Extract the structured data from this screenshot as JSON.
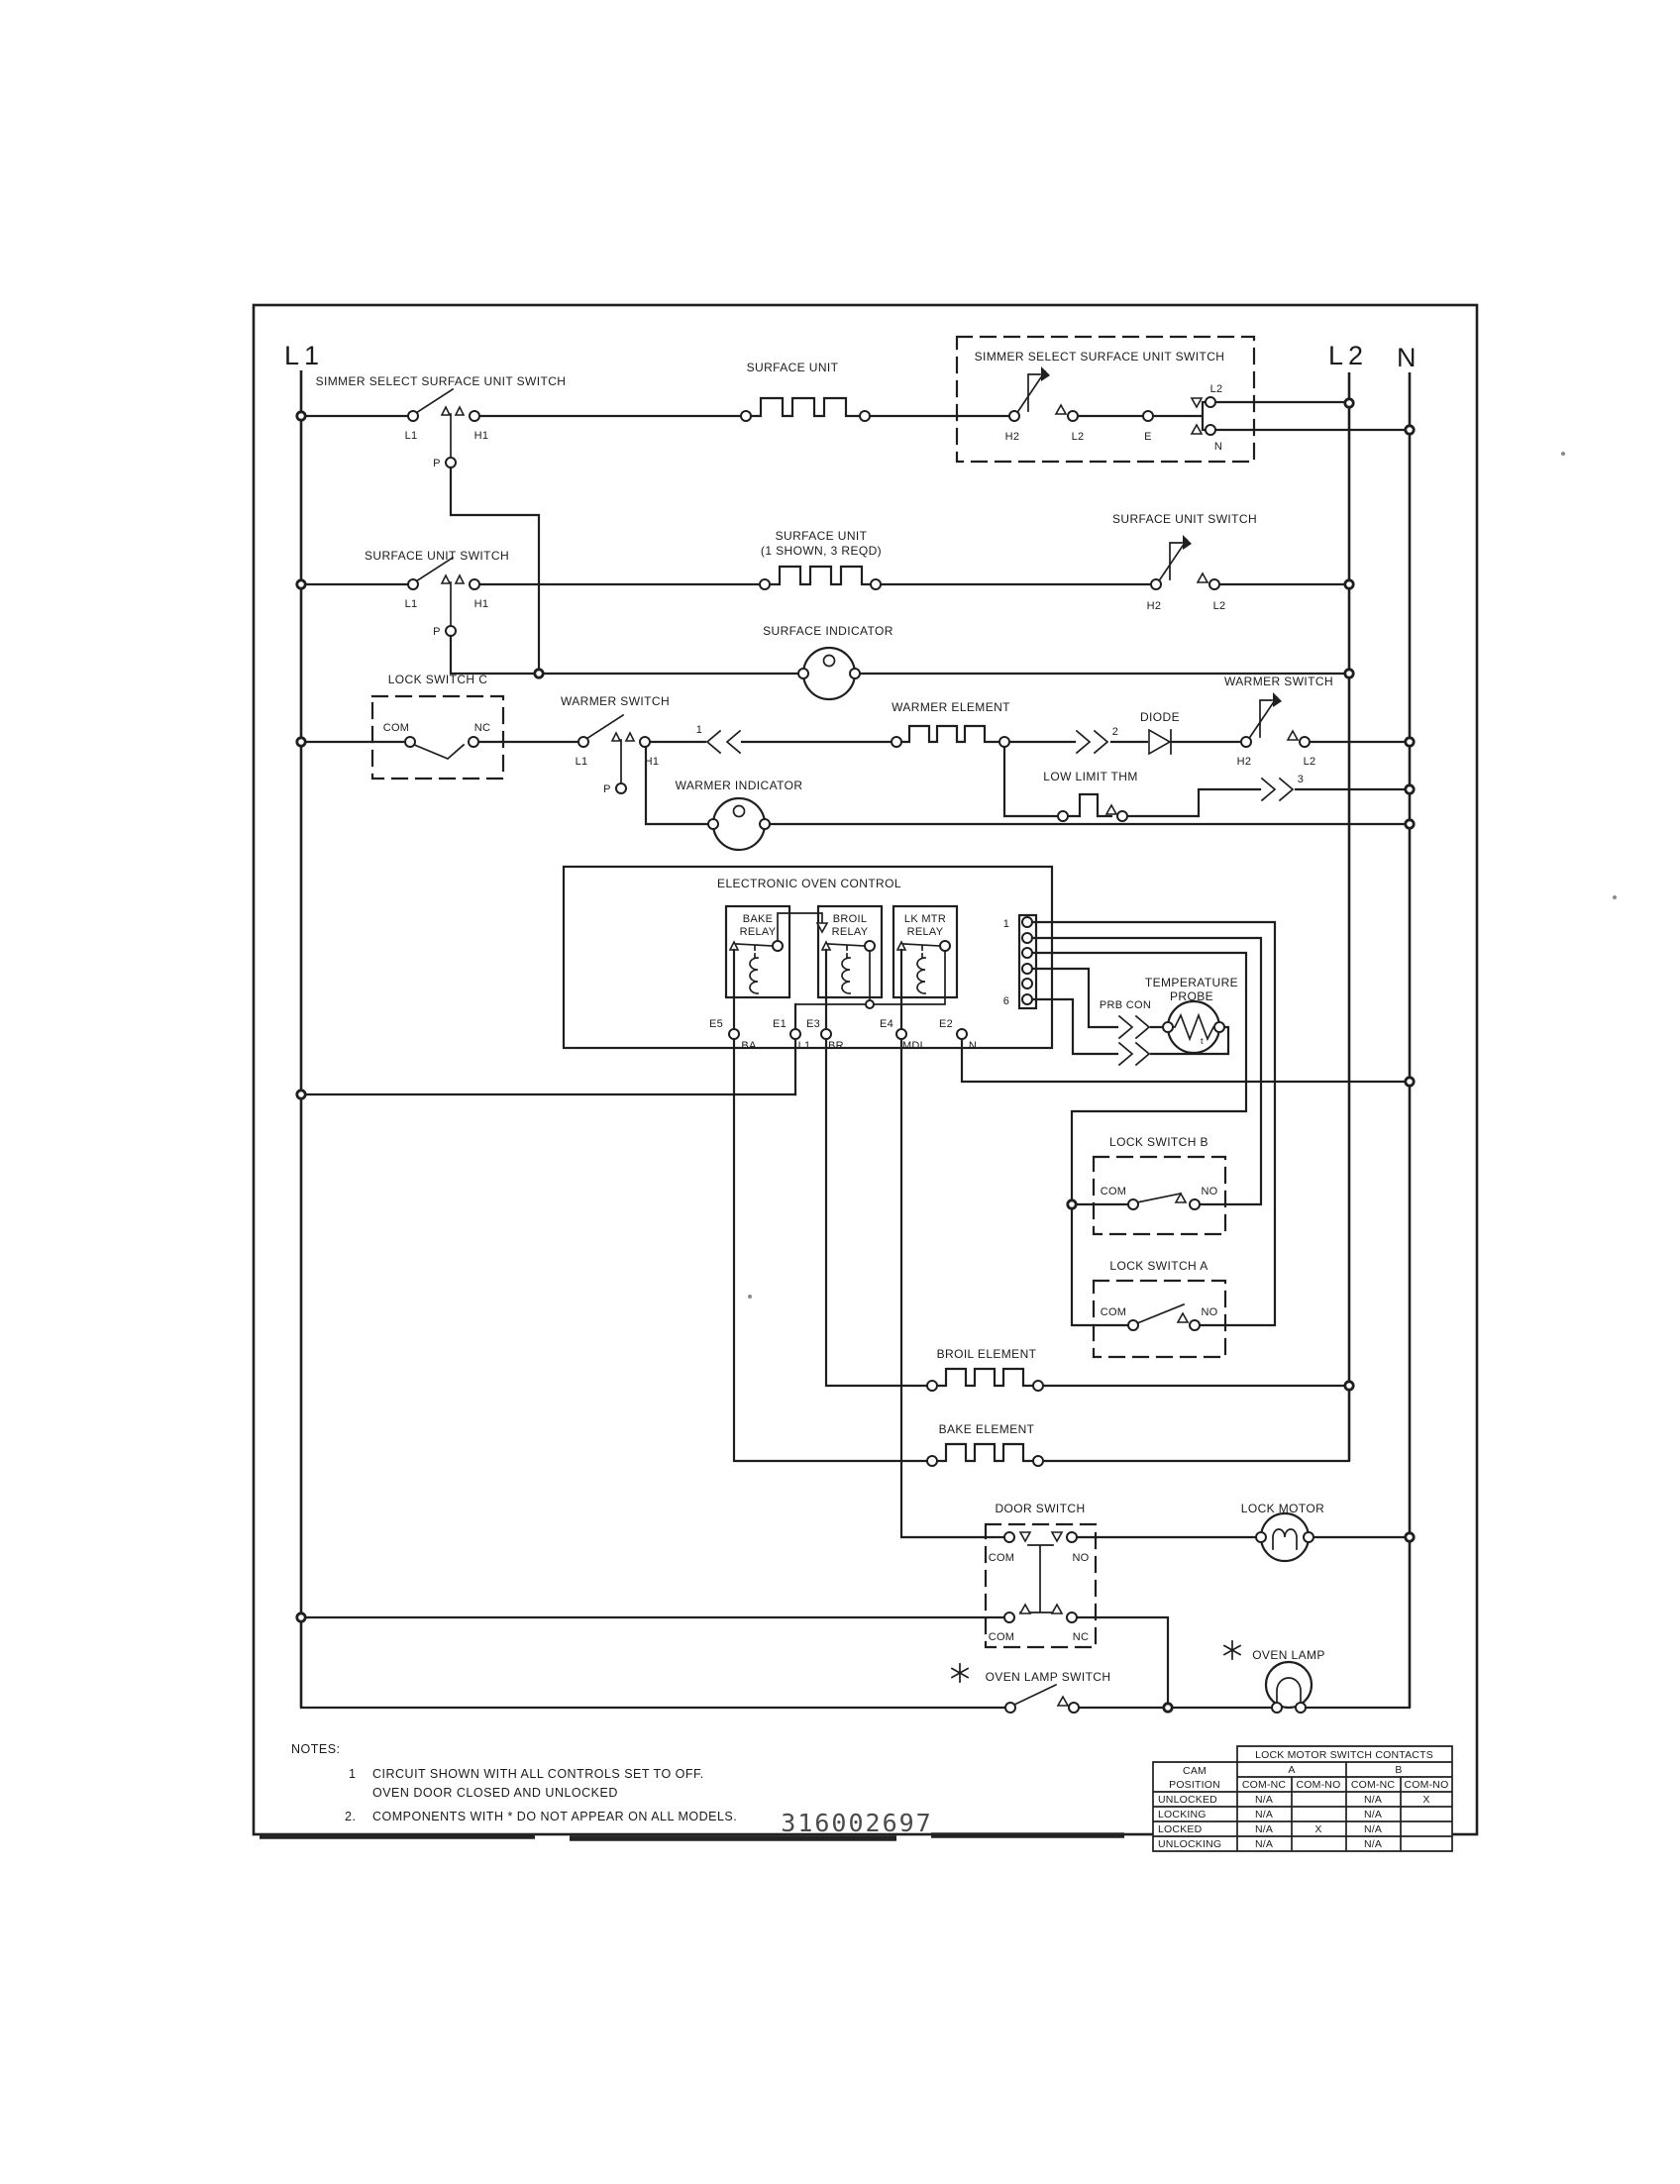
{
  "power": {
    "l1": "L1",
    "l2": "L2",
    "n": "N"
  },
  "labels": {
    "simmer_select_switch": "SIMMER SELECT SURFACE UNIT SWITCH",
    "surface_unit": "SURFACE UNIT",
    "surface_unit_switch": "SURFACE UNIT SWITCH",
    "surface_unit_multi_1": "SURFACE UNIT",
    "surface_unit_multi_2": "(1 SHOWN, 3 REQD)",
    "surface_indicator": "SURFACE INDICATOR",
    "lock_switch_c": "LOCK SWITCH C",
    "warmer_switch": "WARMER SWITCH",
    "warmer_element": "WARMER ELEMENT",
    "diode": "DIODE",
    "low_limit_thm": "LOW LIMIT THM",
    "warmer_indicator": "WARMER INDICATOR",
    "eoc": "ELECTRONIC OVEN CONTROL",
    "bake": "BAKE",
    "broil": "BROIL",
    "lk_mtr": "LK MTR",
    "relay": "RELAY",
    "temperature": "TEMPERATURE",
    "probe": "PROBE",
    "prb_con": "PRB CON",
    "lock_switch_b": "LOCK SWITCH B",
    "lock_switch_a": "LOCK SWITCH A",
    "broil_element": "BROIL ELEMENT",
    "bake_element": "BAKE ELEMENT",
    "door_switch": "DOOR SWITCH",
    "lock_motor": "LOCK MOTOR",
    "oven_lamp_switch": "OVEN LAMP SWITCH",
    "oven_lamp": "OVEN LAMP"
  },
  "terminals": {
    "l1": "L1",
    "p": "P",
    "h1": "H1",
    "h2": "H2",
    "l2": "L2",
    "e": "E",
    "n": "N",
    "com": "COM",
    "nc": "NC",
    "no": "NO",
    "e5": "E5",
    "e1": "E1",
    "e3": "E3",
    "e4": "E4",
    "e2": "E2",
    "ba": "BA",
    "br": "BR",
    "mdl": "MDL",
    "pin1": "1",
    "pin6": "6",
    "t": "t"
  },
  "connectors": {
    "c1": "1",
    "c2": "2",
    "c3": "3"
  },
  "notes": {
    "title": "NOTES:",
    "n1_num": "1",
    "n1_line1": "CIRCUIT SHOWN WITH ALL CONTROLS SET TO OFF.",
    "n1_line2": "OVEN DOOR CLOSED AND UNLOCKED",
    "n2_num": "2.",
    "n2_text": "COMPONENTS WITH * DO NOT APPEAR ON ALL MODELS."
  },
  "part_number": "316002697",
  "table": {
    "title": "LOCK MOTOR SWITCH CONTACTS",
    "cam_line1": "CAM",
    "cam_line2": "POSITION",
    "group_a": "A",
    "group_b": "B",
    "col_headers": [
      "COM-NC",
      "COM-NO",
      "COM-NC",
      "COM-NO"
    ],
    "rows": [
      {
        "label": "UNLOCKED",
        "cells": [
          "N/A",
          "",
          "N/A",
          "X"
        ]
      },
      {
        "label": "LOCKING",
        "cells": [
          "N/A",
          "",
          "N/A",
          ""
        ]
      },
      {
        "label": "LOCKED",
        "cells": [
          "N/A",
          "X",
          "N/A",
          ""
        ]
      },
      {
        "label": "UNLOCKING",
        "cells": [
          "N/A",
          "",
          "N/A",
          ""
        ]
      }
    ]
  }
}
